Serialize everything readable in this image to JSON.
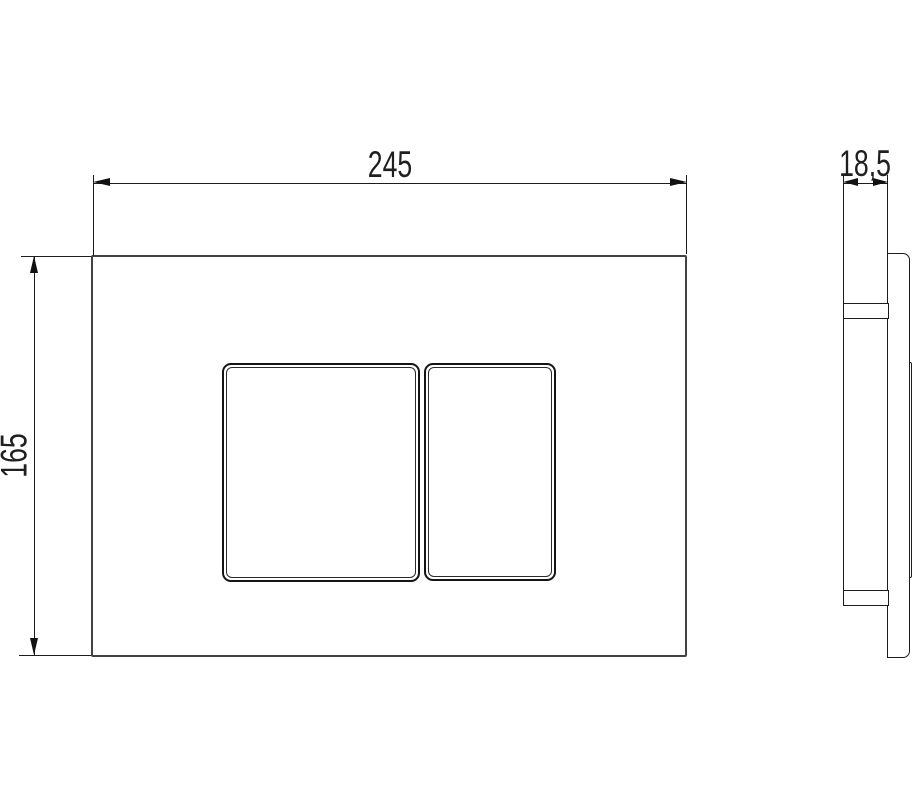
{
  "drawing": {
    "title": "dual-flush actuator plate dimension drawing",
    "views": {
      "front": {
        "name": "front view",
        "plate": "flush plate face",
        "buttons": [
          "large flush button",
          "small flush button"
        ]
      },
      "side": {
        "name": "side profile view",
        "parts": [
          "plate body",
          "rear frame bump",
          "top mounting tab",
          "bottom mounting tab"
        ]
      }
    },
    "dimensions": {
      "width": {
        "label": "245",
        "orientation": "horizontal",
        "applies_to": "plate width (mm)"
      },
      "height": {
        "label": "165",
        "orientation": "vertical",
        "applies_to": "plate height (mm)"
      },
      "depth": {
        "label": "18,5",
        "orientation": "horizontal",
        "applies_to": "plate depth (mm)"
      }
    },
    "colors": {
      "background": "#ffffff",
      "line": "#1c1c1c",
      "plate_border": "#424242"
    }
  }
}
